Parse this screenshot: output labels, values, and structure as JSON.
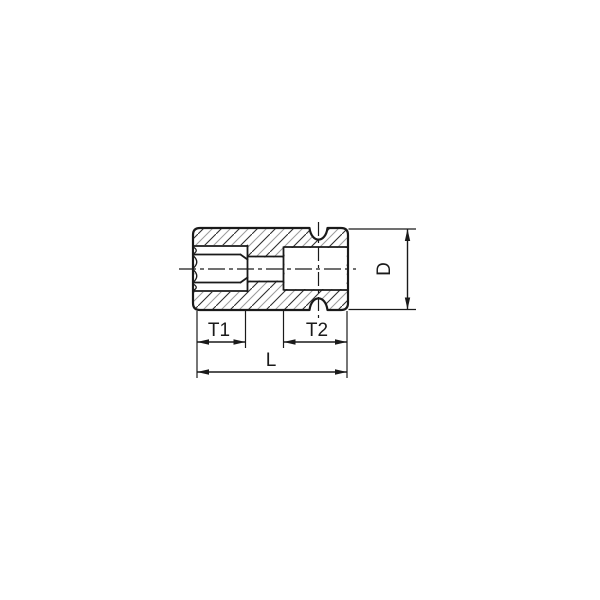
{
  "page": {
    "background_color": "#ffffff",
    "line_color": "#1a1a1a",
    "hatch_color_dark": "#2f2f2f",
    "hatch_color_light": "#9a9a9a"
  },
  "drawing": {
    "kind": "socket cross-section technical drawing",
    "labels": {
      "t1": "T1",
      "t2": "T2",
      "length": "L",
      "diameter": "D"
    }
  }
}
